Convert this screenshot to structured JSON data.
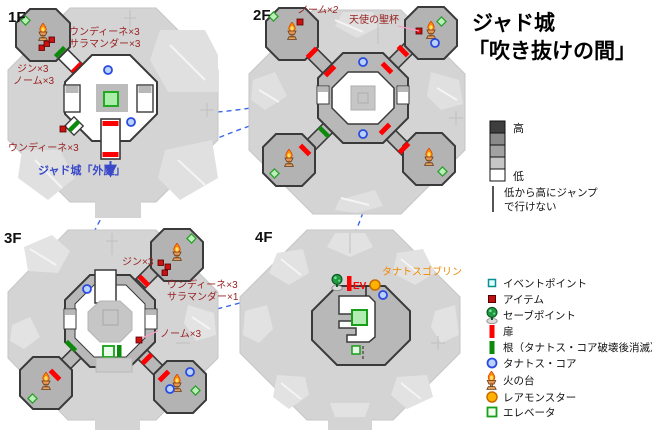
{
  "title": {
    "line1": "ジャド城",
    "line2": "「吹き抜けの間」"
  },
  "floors": {
    "f1": {
      "label": "1F",
      "enemy_group_a1": "ウンディーネ×3",
      "enemy_group_a2": "サラマンダー×3",
      "enemy_group_b1": "ジン×3",
      "enemy_group_b2": "ノーム×3",
      "enemy_group_c": "ウンディーネ×3",
      "exit_label": "ジャド城「外庭」"
    },
    "f2": {
      "label": "2F",
      "enemy_group_a": "ノーム×2",
      "treasure_label": "天使の聖杯"
    },
    "f3": {
      "label": "3F",
      "enemy_group_a": "ジン×3",
      "enemy_group_b1": "ウンディーネ×3",
      "enemy_group_b2": "サラマンダー×1",
      "enemy_group_c": "ノーム×3"
    },
    "f4": {
      "label": "4F",
      "enemy_label": "タナトスゴブリン",
      "elevator_door_label": "EV"
    }
  },
  "elevation": {
    "high": "高",
    "low": "低",
    "note_line1": "低から高にジャンプ",
    "note_line2": "で行けない",
    "shades": [
      "#3e3e3e",
      "#8a8a8a",
      "#a2a2a2",
      "#c6c6c6",
      "#ffffff"
    ]
  },
  "legend": {
    "items": [
      {
        "icon": "event-point",
        "label": "イベントポイント"
      },
      {
        "icon": "item",
        "label": "アイテム"
      },
      {
        "icon": "save-point",
        "label": "セーブポイント"
      },
      {
        "icon": "door",
        "label": "扉"
      },
      {
        "icon": "root",
        "label": "根（タナトス・コア破壊後消滅）"
      },
      {
        "icon": "thanatos-core",
        "label": "タナトス・コア"
      },
      {
        "icon": "fire-stand",
        "label": "火の台"
      },
      {
        "icon": "rare-monster",
        "label": "レアモンスター"
      },
      {
        "icon": "elevator",
        "label": "エレベータ"
      }
    ]
  },
  "colors": {
    "door_red": "#ff0000",
    "root_green": "#0b8a0b",
    "core_blue": "#2b4be0",
    "elevator_green": "#17a017",
    "enemy_text": "#992222",
    "exit_text": "#3949c8",
    "rare_orange": "#ffb300",
    "warn_orange": "#ef8800",
    "link_dash_blue": "#3a66e8",
    "raised_gray": "#b3b3b3",
    "floor_gray": "#d4d4d4"
  }
}
